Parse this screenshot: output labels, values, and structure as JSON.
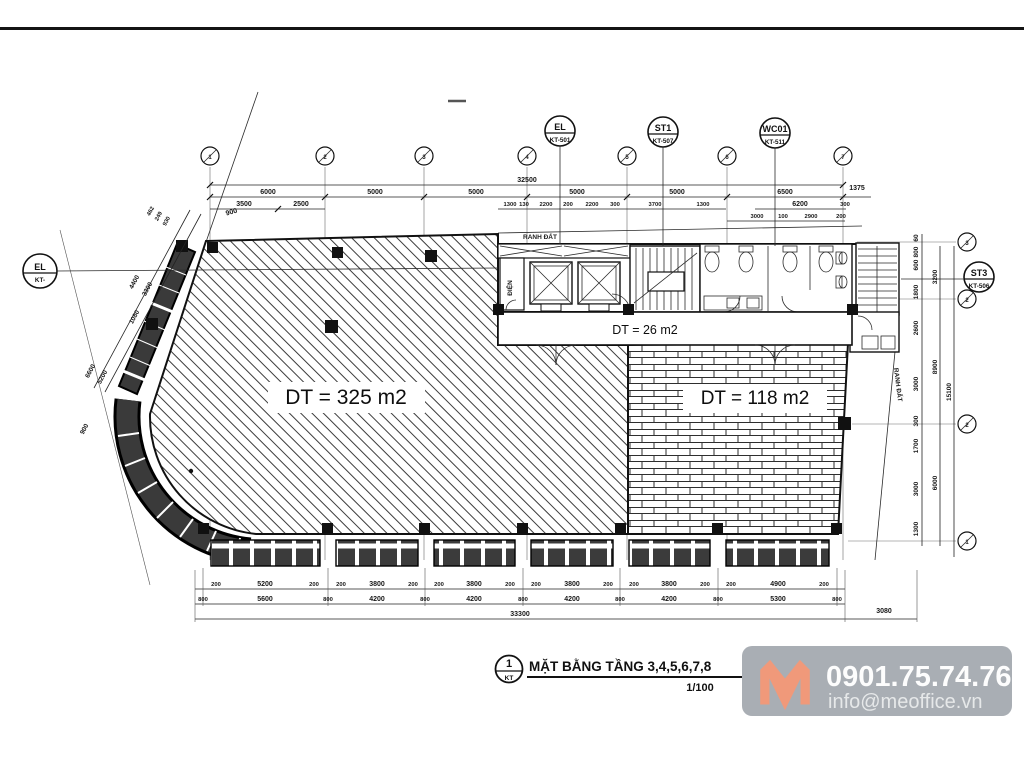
{
  "title_block": {
    "detail_number": "1",
    "detail_sheet": "KT",
    "title": "MẶT BẰNG TẦNG 3,4,5,6,7,8",
    "scale": "1/100"
  },
  "contact": {
    "phone": "0901.75.74.76",
    "email": "info@meoffice.vn",
    "badge_bg": "#a9aeb4",
    "logo_color": "#f0997a"
  },
  "areas": {
    "main_area": "DT = 325 m2",
    "brick_area": "DT = 118 m2",
    "corridor_area": "DT = 26 m2"
  },
  "plan_labels": {
    "ranh_dat_top": "RANH ĐẤT",
    "ranh_dat_right": "RANH ĐẤT",
    "dien_room": "ĐIỆN"
  },
  "callouts": {
    "el_top": {
      "title": "EL",
      "ref": "KT-501"
    },
    "st1": {
      "title": "ST1",
      "ref": "KT-507"
    },
    "wc01": {
      "title": "WC01",
      "ref": "KT-511"
    },
    "st3": {
      "title": "ST3",
      "ref": "KT-506"
    },
    "el_left": {
      "title": "EL",
      "ref": "KT-"
    }
  },
  "grid_bubbles": {
    "top": [
      "1",
      "2",
      "3",
      "4",
      "5",
      "6",
      "7"
    ],
    "right": [
      "3",
      "2",
      "2",
      "1"
    ]
  },
  "dims": {
    "top": {
      "overall": "32500",
      "spans": [
        "6000",
        "5000",
        "5000",
        "5000",
        "5000",
        "6500"
      ],
      "right_ext": "1375",
      "sub_left": [
        "3500",
        "2500"
      ],
      "sub_core": [
        "1300",
        "130",
        "2200",
        "200",
        "2200",
        "300",
        "3700",
        "1300"
      ],
      "sub_right": [
        "6200",
        "300"
      ],
      "sub_right2": [
        "3000",
        "100",
        "2900",
        "200"
      ],
      "small_900": "900"
    },
    "bottom": {
      "row_inner": [
        "200",
        "5200",
        "200",
        "200",
        "3800",
        "200",
        "200",
        "3800",
        "200",
        "200",
        "3800",
        "200",
        "200",
        "3800",
        "200",
        "200",
        "4900",
        "200"
      ],
      "row_outer": [
        "800",
        "5600",
        "800",
        "4200",
        "800",
        "4200",
        "800",
        "4200",
        "800",
        "4200",
        "800",
        "5300",
        "800"
      ],
      "overall": "33300",
      "right_ext": "3080"
    },
    "right": {
      "inner": [
        "60",
        "800",
        "600",
        "1800",
        "2600",
        "3000",
        "300",
        "1700",
        "3000",
        "1300"
      ],
      "mid": [
        "3200",
        "8900",
        "6000"
      ],
      "overall": "15100"
    },
    "left": {
      "outer": [
        "4400",
        "6600"
      ],
      "inner": [
        "3300",
        "1080",
        "5200",
        "900"
      ],
      "tiny": [
        "462",
        "249",
        "930"
      ]
    }
  }
}
